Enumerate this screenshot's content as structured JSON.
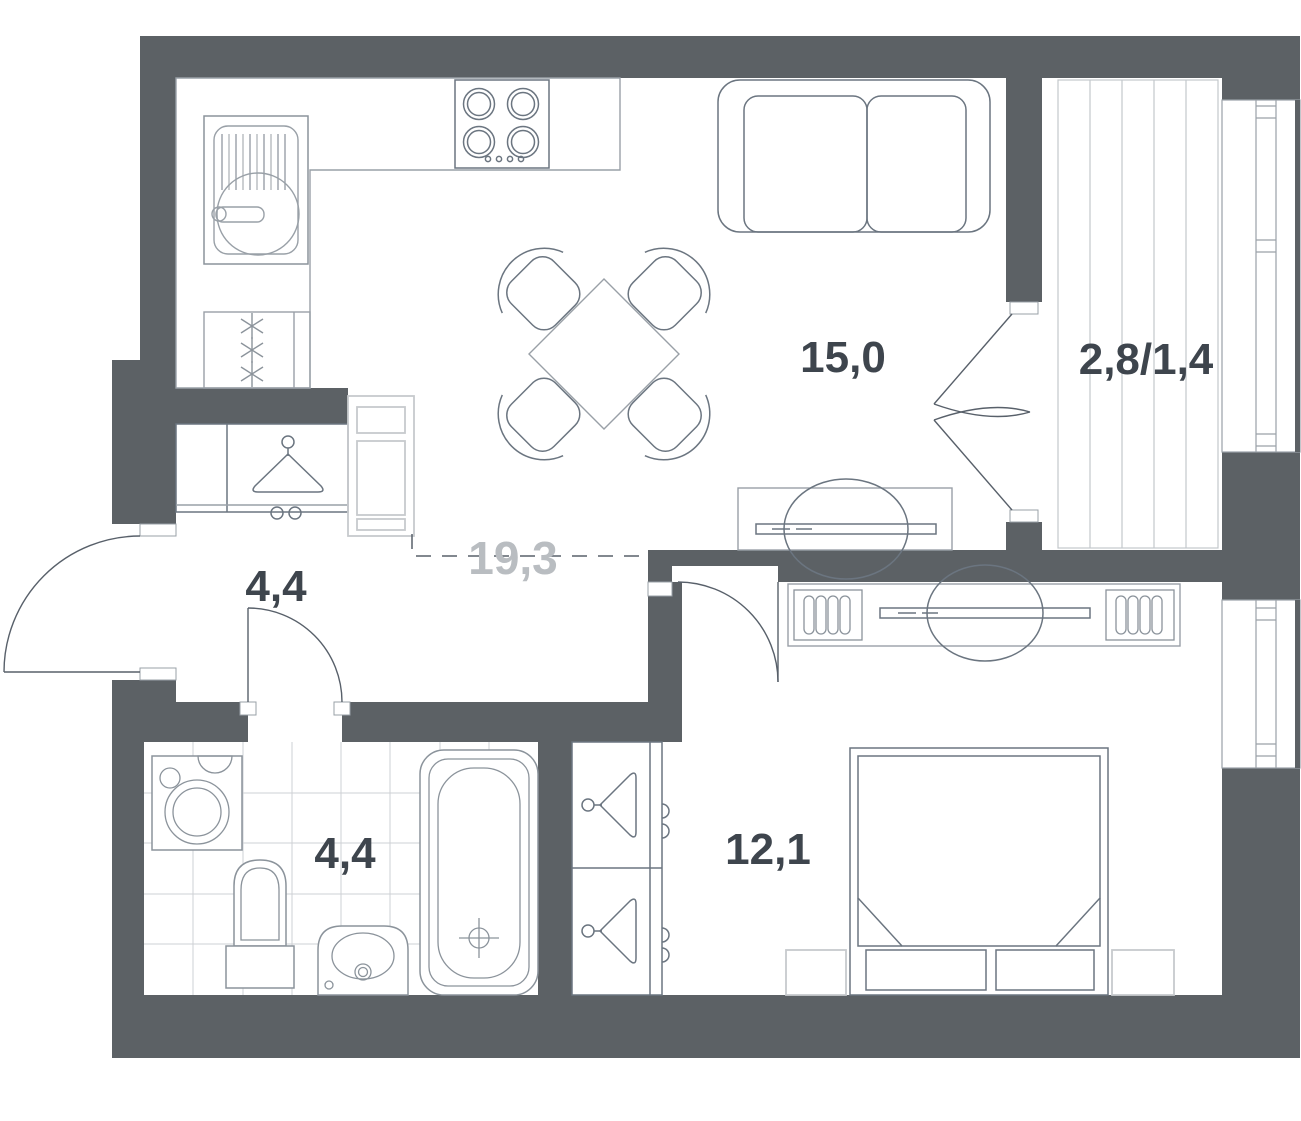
{
  "labels": {
    "living_kitchen": "15,0",
    "combined": "19,3",
    "balcony": "2,8/1,4",
    "hallway": "4,4",
    "bathroom": "4,4",
    "bedroom": "12,1"
  },
  "colors": {
    "background": "#ffffff",
    "wall": "#5c6165",
    "furniture": "#6b7580",
    "fixture": "#8b939b",
    "counter": "#99a0a7",
    "light": "#c7cacd",
    "tile": "#cdd0d4",
    "deck": "#c3c7cb",
    "label": "#3e454d",
    "label_muted": "#b9bdc1",
    "door": "#58606a",
    "glass": "#9aa1a8"
  },
  "icons": [
    "kitchen-sink-icon",
    "stove-icon",
    "fridge-icon",
    "dining-table-icon",
    "dining-chair-icon",
    "sofa-icon",
    "tv-console-icon",
    "tv-icon",
    "hanger-icon",
    "cabinet-icon",
    "washing-machine-icon",
    "toilet-icon",
    "bathroom-sink-icon",
    "bathtub-icon",
    "bed-icon",
    "nightstand-icon",
    "bookshelf-icon",
    "door-swing-icon",
    "french-door-icon",
    "window-icon",
    "balcony-decking-icon"
  ]
}
